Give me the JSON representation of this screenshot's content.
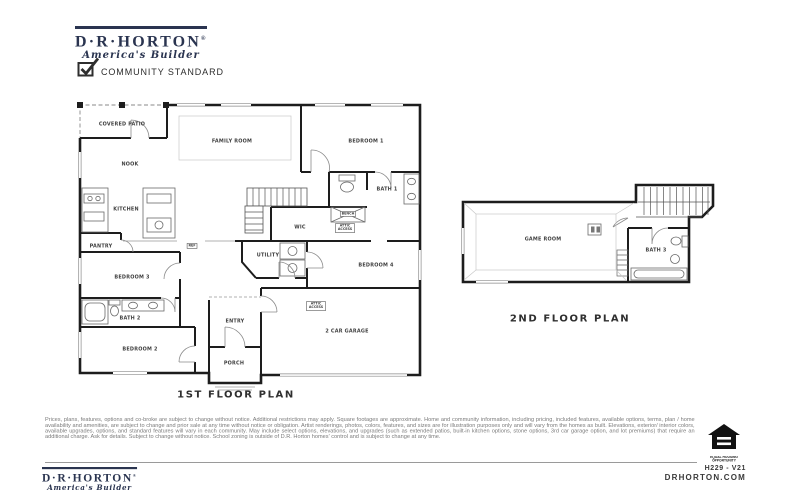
{
  "brand": {
    "name": "D·R·HORTON",
    "mark": "®",
    "tagline": "America's Builder",
    "checkbox_label": "COMMUNITY STANDARD"
  },
  "plan1": {
    "title": "1ST FLOOR PLAN",
    "rooms": [
      {
        "label": "COVERED PATIO"
      },
      {
        "label": "FAMILY ROOM"
      },
      {
        "label": "BEDROOM 1"
      },
      {
        "label": "NOOK"
      },
      {
        "label": "KITCHEN"
      },
      {
        "label": "BATH 1"
      },
      {
        "label": "BENCH"
      },
      {
        "label": "WIC"
      },
      {
        "label": "ATTIC ACCESS"
      },
      {
        "label": "PANTRY"
      },
      {
        "label": "REF"
      },
      {
        "label": "UTILITY"
      },
      {
        "label": "BEDROOM 4"
      },
      {
        "label": "BEDROOM 3"
      },
      {
        "label": "BATH 2"
      },
      {
        "label": "ENTRY"
      },
      {
        "label": "ATTIC ACCESS"
      },
      {
        "label": "2 CAR GARAGE"
      },
      {
        "label": "BEDROOM 2"
      },
      {
        "label": "PORCH"
      }
    ]
  },
  "plan2": {
    "title": "2ND FLOOR PLAN",
    "rooms": [
      {
        "label": "GAME ROOM"
      },
      {
        "label": "BATH 3"
      }
    ]
  },
  "disclaimer": "Prices, plans, features, options and co-broke are subject to change without notice. Additional restrictions may apply.  Square footages are approximate. Home and community information, including pricing, included features, available options, terms, plan / home availability and amenities, are subject to change and prior sale at any time without notice or obligation. Artist renderings, photos, colors, features, and sizes are for illustration purposes only and will vary from the homes as built. Elevations, exterior/ interior colors, available upgrades, options, and standard features will vary in each community. May include select options, elevations, and upgrades (such as extended patios, built-in kitchen options, stone options, 3rd car garage option, and lot premiums) that require an additional charge. Ask for details. Subject to change without notice. School zoning is outside of D.R. Horton homes' control and is subject to change at any time.",
  "footer": {
    "plan_code": "H229 - V21",
    "website": "DRHORTON.COM",
    "equal_housing": "EQUAL HOUSING OPPORTUNITY"
  },
  "colors": {
    "brand_navy": "#2a3450",
    "wall_black": "#1d1d1d",
    "text_gray": "#7b7b7b"
  }
}
